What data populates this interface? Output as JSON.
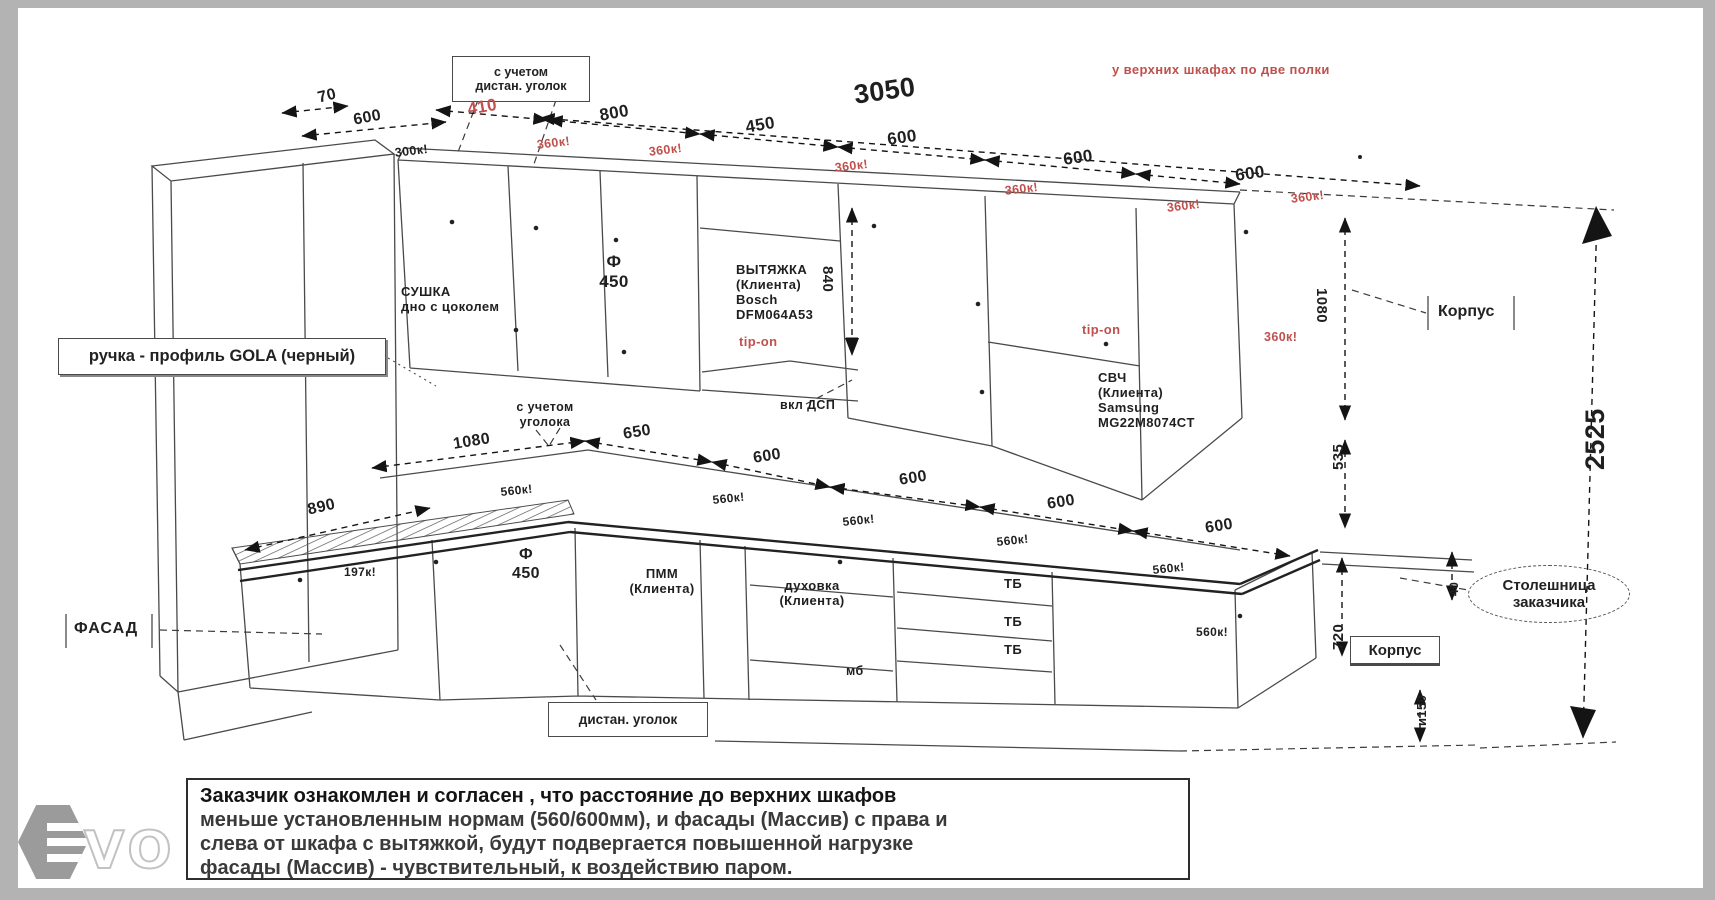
{
  "title": "Кухня — технический чертеж (эскиз с размерами)",
  "labels": {
    "d70": {
      "t": "70"
    },
    "d600a": {
      "t": "600"
    },
    "d410": {
      "t": "410",
      "c": "red"
    },
    "d800": {
      "t": "800"
    },
    "d450": {
      "t": "450"
    },
    "d3050": {
      "t": "3050"
    },
    "d600b": {
      "t": "600"
    },
    "d600c": {
      "t": "600"
    },
    "d600d": {
      "t": "600"
    },
    "k300": {
      "t": "300к!"
    },
    "k360a": {
      "t": "360к!",
      "c": "red"
    },
    "k360b": {
      "t": "360к!",
      "c": "red"
    },
    "k360c": {
      "t": "360к!",
      "c": "red"
    },
    "k360d": {
      "t": "360к!",
      "c": "red"
    },
    "k360e": {
      "t": "360к!",
      "c": "red"
    },
    "k360f": {
      "t": "360к!",
      "c": "red"
    },
    "k360g": {
      "t": "360к!",
      "c": "red"
    },
    "sushka": {
      "t": "СУШКА\nдно с цоколем"
    },
    "f450u": {
      "t": "Ф\n450"
    },
    "hood": {
      "t": "ВЫТЯЖКА\n(Клиента)\nBosch\nDFM064A53"
    },
    "tipon1": {
      "t": "tip-on",
      "c": "red"
    },
    "d840": {
      "t": "840"
    },
    "svch": {
      "t": "СВЧ\n(Клиента)\nSamsung\nMG22M8074CT"
    },
    "tipon2": {
      "t": "tip-on",
      "c": "red"
    },
    "d1080r": {
      "t": "1080"
    },
    "d1080m": {
      "t": "1080"
    },
    "d650": {
      "t": "650"
    },
    "d600e": {
      "t": "600"
    },
    "d600f": {
      "t": "600"
    },
    "d600g": {
      "t": "600"
    },
    "d600h": {
      "t": "600"
    },
    "d890": {
      "t": "890"
    },
    "k560a": {
      "t": "560к!"
    },
    "k560b": {
      "t": "560к!"
    },
    "k560c": {
      "t": "560к!"
    },
    "k560d": {
      "t": "560к!"
    },
    "k560e": {
      "t": "560к!"
    },
    "k560f": {
      "t": "560к!"
    },
    "k197": {
      "t": "197к!"
    },
    "f450b": {
      "t": "Ф\n450"
    },
    "pmm": {
      "t": "ПММ\n(Клиента)"
    },
    "duh": {
      "t": "духовка\n(Клиента)"
    },
    "tb1": {
      "t": "ТБ"
    },
    "tb2": {
      "t": "ТБ"
    },
    "tb3": {
      "t": "ТБ"
    },
    "mb": {
      "t": "мб"
    },
    "d2525": {
      "t": "2525"
    },
    "d535": {
      "t": "535"
    },
    "d720": {
      "t": "720"
    },
    "d40": {
      "t": "40"
    },
    "d150": {
      "t": "и150"
    },
    "note_top_right": {
      "t": "у верхних шкафах по две полки",
      "c": "red"
    },
    "note_mid": {
      "t": "с учетом\nуголока"
    },
    "dsp": {
      "t": "вкл ДСП"
    }
  },
  "callouts": {
    "box_top": {
      "t": "с учетом\nдистан. уголок"
    },
    "gola": {
      "t": "ручка - профиль GOLA (черный)"
    },
    "fasad": {
      "t": "ФАСАД"
    },
    "korpus_upper": {
      "t": "Корпус"
    },
    "korpus_lower": {
      "t": "Корпус"
    },
    "box_bottom": {
      "t": "дистан. уголок"
    },
    "stol": {
      "t": "Столешница\nзаказчика"
    }
  },
  "disclaimer": {
    "lines": [
      "Заказчик ознакомлен и согласен , что расстояние до верхних шкафов",
      "меньше установленным нормам (560/600мм), и фасады (Массив) с права и",
      "слева от шкафа с вытяжкой, будут подвергается повышенной нагрузке",
      "фасады (Массив) - чувствительный, к воздействию паром."
    ]
  },
  "logo": {
    "vo": "VO"
  }
}
